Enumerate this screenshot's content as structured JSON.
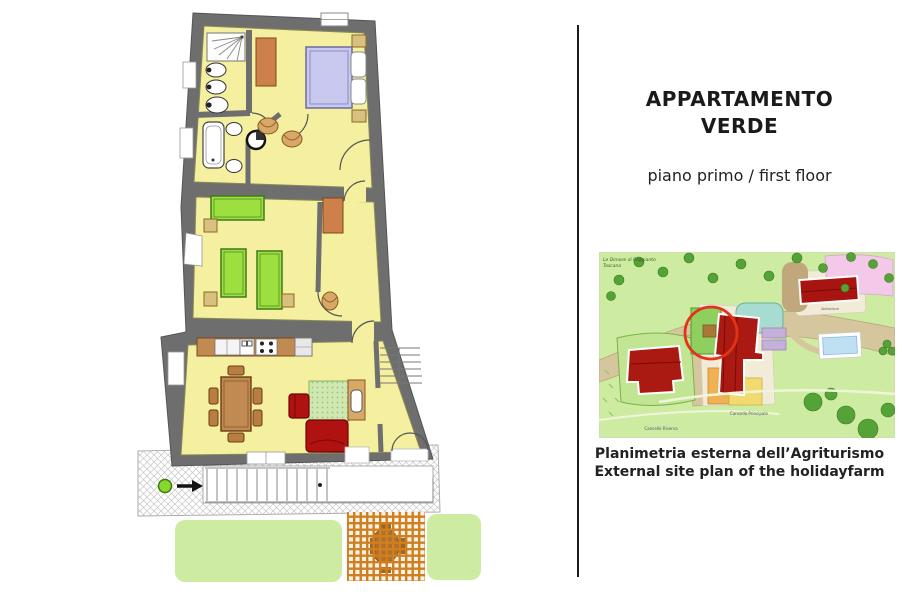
{
  "right_panel": {
    "title_line1": "APPARTAMENTO",
    "title_line2": "VERDE",
    "subtitle": "piano primo / first floor",
    "map_caption_line1": "Planimetria esterna dell’Agriturismo",
    "map_caption_line2": "External site plan of the holidayfarm"
  },
  "site_map": {
    "labels": {
      "estate_line1": "Le Dimore di Poggianto",
      "estate_line2": "Toscana",
      "main_building": "Abitazione",
      "road_main": "Cancello Principale",
      "road_secondary": "Cancello Riserva"
    },
    "colors": {
      "grass": "#cdeca2",
      "tree": "#55a237",
      "path": "#d6c69e",
      "plot_cream": "#f1ebd8",
      "building_red": "#ab1a12",
      "pool_water": "#bfe0f2",
      "pink_area": "#f4c8e8",
      "teal_area": "#a8dcd0",
      "lavender_area": "#c4b0d8",
      "orange_plot": "#f0b054",
      "yellow_plot": "#f2da70",
      "highlight_circle": "#e23318"
    }
  },
  "floor_plan": {
    "label": "Appartamento Verde - first floor plan",
    "rooms": [
      "bathroom-1",
      "double-bedroom",
      "bathroom-2",
      "vestibule",
      "twin-bedroom",
      "corridor",
      "kitchen-dining",
      "living-area",
      "stair-hall",
      "terrace",
      "lawn",
      "pergola"
    ],
    "icons": {
      "entrance_marker": "green-dot-with-arrow",
      "shower": "spray-lines-square",
      "stairs": "tread-lines"
    },
    "colors": {
      "wall": "#6e6e6e",
      "floor": "#f5efa0",
      "bed_double": "#c9c9ef",
      "bed_single": "#9ddf3e",
      "wardrobe": "#cd8049",
      "sofa_armchair": "#b01111",
      "table": "#c08a52",
      "rug": "#cfe8b2",
      "lawn": "#cdeca2",
      "pergola_lattice": "#cf7f1f",
      "entrance_dot": "#86d82a"
    }
  }
}
